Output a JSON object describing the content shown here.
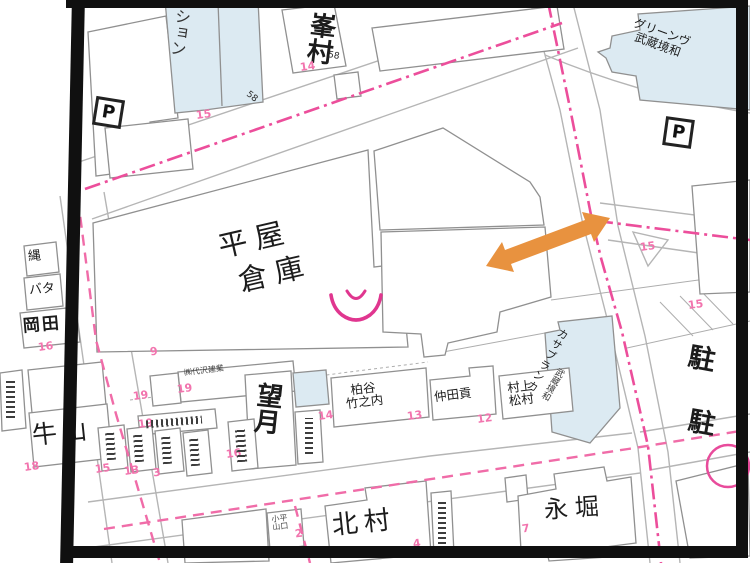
{
  "map": {
    "labels": {
      "mansion_partial": "ション",
      "minemura": "峯村",
      "green_line1": "グリーンヴ",
      "green_line2": "武蔵境和",
      "parking_p_left": "P",
      "parking_p_right": "P",
      "hiraya": "平屋",
      "souko": "倉庫",
      "nawa": "縄",
      "bata": "バタ",
      "okada": "岡田",
      "ushiyama": "牛山",
      "daisawa": "㈱代沢建業",
      "mochizuki": "望月",
      "kashiwaya_line1": "柏谷",
      "kashiwaya_line2": "竹之内",
      "nakada": "仲田貢",
      "murakami_line1": "村上",
      "murakami_line2": "松村",
      "casablanca_line1": "カサブランカ",
      "casablanca_line2": "武蔵境和",
      "chu_upper": "駐",
      "chu_lower": "駐",
      "kodaira_line1": "小平",
      "kodaira_line2": "山口",
      "kitamura": "北村",
      "nagahori": "永堀"
    },
    "black_numbers": [
      {
        "v": "58"
      },
      {
        "v": "58"
      }
    ],
    "pink_numbers": [
      {
        "v": "15"
      },
      {
        "v": "14"
      },
      {
        "v": "15"
      },
      {
        "v": "15"
      },
      {
        "v": "9"
      },
      {
        "v": "16"
      },
      {
        "v": "18"
      },
      {
        "v": "19"
      },
      {
        "v": "19"
      },
      {
        "v": "19"
      },
      {
        "v": "14"
      },
      {
        "v": "13"
      },
      {
        "v": "12"
      },
      {
        "v": "2"
      },
      {
        "v": "4"
      },
      {
        "v": "7"
      },
      {
        "v": "15"
      },
      {
        "v": "13"
      },
      {
        "v": "3"
      },
      {
        "v": "16"
      }
    ],
    "colors": {
      "road_pink": "#EC4E9B",
      "road_pink_light": "#F06CA8",
      "pink_number": "#F274AE",
      "building_stroke": "#909090",
      "road_edge_gray": "#B5B5B5",
      "light_blue_fill": "#DCEAF2",
      "arrow_orange": "#E8923F",
      "frame_black": "#101010"
    }
  }
}
